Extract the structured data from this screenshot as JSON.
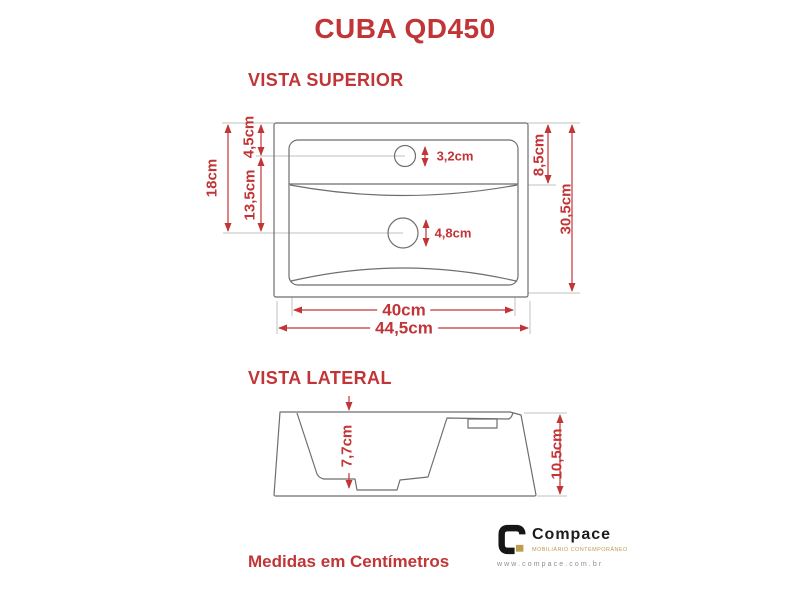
{
  "title": "CUBA QD450",
  "footer_note": "Medidas em Centímetros",
  "views": {
    "superior": {
      "label": "VISTA SUPERIOR",
      "dims": {
        "depth_total": "18cm",
        "depth_drain": "13,5cm",
        "depth_faucet": "4,5cm",
        "faucet_hole": "3,2cm",
        "drain_hole": "4,8cm",
        "ledge_depth": "8,5cm",
        "height_total": "30,5cm",
        "basin_width": "40cm",
        "width_total": "44,5cm"
      }
    },
    "lateral": {
      "label": "VISTA LATERAL",
      "dims": {
        "bowl_depth": "7,7cm",
        "height_total": "10,5cm"
      }
    }
  },
  "logo": {
    "name": "Compace",
    "tagline": "MOBILIÁRIO CONTEMPORÂNEO",
    "website": "www.compace.com.br"
  },
  "colors": {
    "accent": "#c23537",
    "drawing_line": "#6e6e6e",
    "extension_line": "#c2c2c2",
    "logo_gold": "#bf9d50"
  }
}
